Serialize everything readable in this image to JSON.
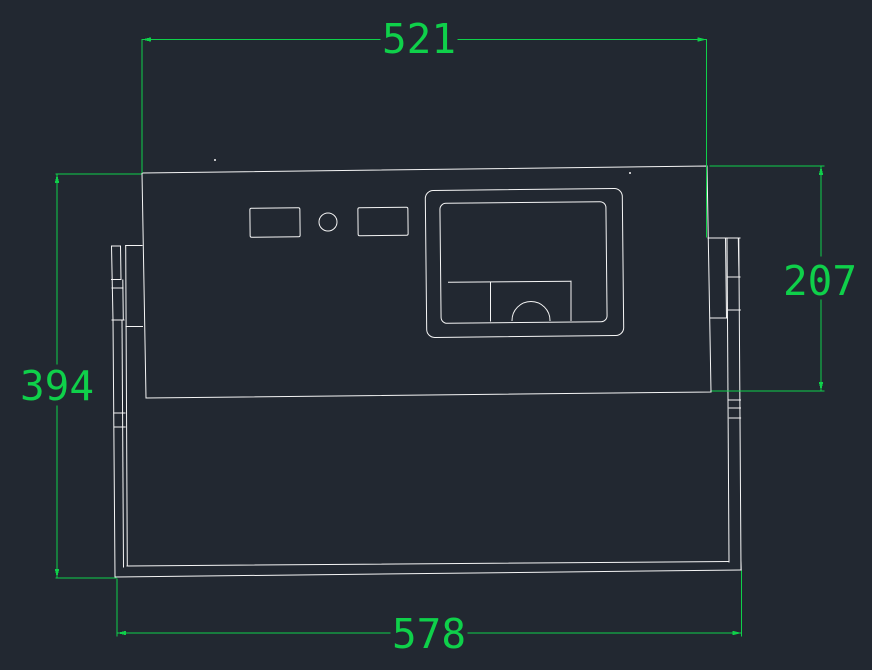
{
  "view": {
    "name": "front-view-drawing"
  },
  "colors": {
    "background": "#222831",
    "geometry": "#f5f5f5",
    "dimension": "#0fd04a"
  },
  "dimensions": {
    "top_width": "521",
    "right_height": "207",
    "left_height": "394",
    "bottom_width": "578"
  }
}
